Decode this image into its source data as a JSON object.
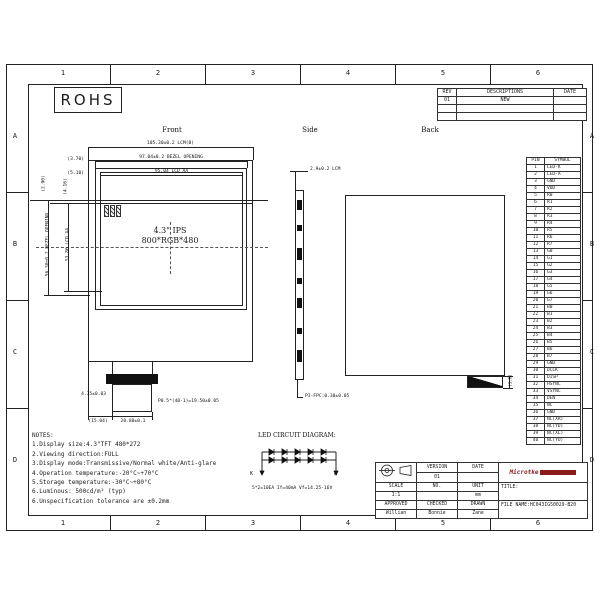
{
  "sheet": {
    "zone_cols": [
      "1",
      "2",
      "3",
      "4",
      "5",
      "6"
    ],
    "zone_rows": [
      "A",
      "B",
      "C",
      "D"
    ],
    "rohs_label": "ROHS"
  },
  "revision_table": {
    "headers": [
      "REV",
      "DESCRIPTIONS",
      "DATE"
    ],
    "rows": [
      [
        "01",
        "NEW",
        ""
      ],
      [
        "",
        "",
        ""
      ],
      [
        "",
        "",
        ""
      ]
    ]
  },
  "views": {
    "front_label": "Front",
    "side_label": "Side",
    "back_label": "Back",
    "screen_size": "4.3\" IPS",
    "screen_res": "800*RGB*480"
  },
  "dims": {
    "lcm_w": "105.30±0.2 LCM(B)",
    "bezel_w": "97.04±0.2 BEZEL OPENING",
    "aa_w": "95.04 LCD AA",
    "off1": "(3.70)",
    "off2": "(5.10)",
    "off3": "(2.90)",
    "off4": "(4.16)",
    "bezel_h": "56.30±0.2 BEZEL OPENING",
    "aa_h": "53.86 LCD AA",
    "tail_off": "4.35±0.03",
    "fpc_pitch": "P0.5*(40-1)=19.50±0.05",
    "tail_x": "(15.04)",
    "tail_w": "20.80±0.1",
    "lcm_t": "2.9±0.2 LCM",
    "fpc_t": "PI-FPC:0.30±0.05",
    "back_step": "(1.0)"
  },
  "pin_table": {
    "headers": [
      "PIN",
      "SYMBOL"
    ],
    "rows": [
      [
        "1",
        "LED-K"
      ],
      [
        "2",
        "LED-A"
      ],
      [
        "3",
        "GND"
      ],
      [
        "4",
        "VDD"
      ],
      [
        "5",
        "R0"
      ],
      [
        "6",
        "R1"
      ],
      [
        "7",
        "R2"
      ],
      [
        "8",
        "R3"
      ],
      [
        "9",
        "R4"
      ],
      [
        "10",
        "R5"
      ],
      [
        "11",
        "R6"
      ],
      [
        "12",
        "R7"
      ],
      [
        "13",
        "G0"
      ],
      [
        "14",
        "G1"
      ],
      [
        "15",
        "G2"
      ],
      [
        "16",
        "G3"
      ],
      [
        "17",
        "G4"
      ],
      [
        "18",
        "G5"
      ],
      [
        "19",
        "G6"
      ],
      [
        "20",
        "G7"
      ],
      [
        "21",
        "B0"
      ],
      [
        "22",
        "B1"
      ],
      [
        "23",
        "B2"
      ],
      [
        "24",
        "B3"
      ],
      [
        "25",
        "B4"
      ],
      [
        "26",
        "B5"
      ],
      [
        "27",
        "B6"
      ],
      [
        "28",
        "B7"
      ],
      [
        "29",
        "GND"
      ],
      [
        "30",
        "DCLK"
      ],
      [
        "31",
        "DISP"
      ],
      [
        "32",
        "HSYNC"
      ],
      [
        "33",
        "VSYNC"
      ],
      [
        "34",
        "DEN"
      ],
      [
        "35",
        "NC"
      ],
      [
        "36",
        "GND"
      ],
      [
        "37",
        "NC(XR)"
      ],
      [
        "38",
        "NC(YD)"
      ],
      [
        "39",
        "NC(XL)"
      ],
      [
        "40",
        "NC(YU)"
      ]
    ]
  },
  "notes": {
    "lines": [
      "NOTES:",
      "1.Display size:4.3\"TFT 480*272",
      "2.Viewing direction:FULL",
      "3.Display mode:Transmissive/Normal white/Anti-glare",
      "4.Operation temperature:-20°C~+70°C",
      "5.Storage temperature:-30°C~+80°C",
      "6.Luminous: 500cd/m² (typ)",
      "6.Unspecification tolerance are ±0.2mm"
    ]
  },
  "led_diagram": {
    "title": "LED CIRCUIT DIAGRAM:",
    "cathode_label": "K",
    "anode_label": "A",
    "caption": "5*2=10EA  If=40mA Vf=14.25-16V"
  },
  "title_block": {
    "version_label": "VERSION",
    "date_label": "DATE",
    "version_value": "01",
    "date_value": "",
    "scale_label": "SCALE",
    "no_label": "NO.",
    "unit_label": "UNIT",
    "scale_value": "1:1",
    "no_value": "",
    "unit_value": "mm",
    "approved_label": "APPROVED",
    "checked_label": "CHECKED",
    "drawn_label": "DRAWN",
    "approved_value": "Willian",
    "checked_value": "Bonnie",
    "drawn_value": "Zane",
    "logo_text": "Microtke",
    "title_label": "TITLE:",
    "file_name": "FILE NAME:HC043IG50029-B20"
  },
  "colors": {
    "line": "#1c1c1c",
    "logo": "#8a1b1b"
  }
}
